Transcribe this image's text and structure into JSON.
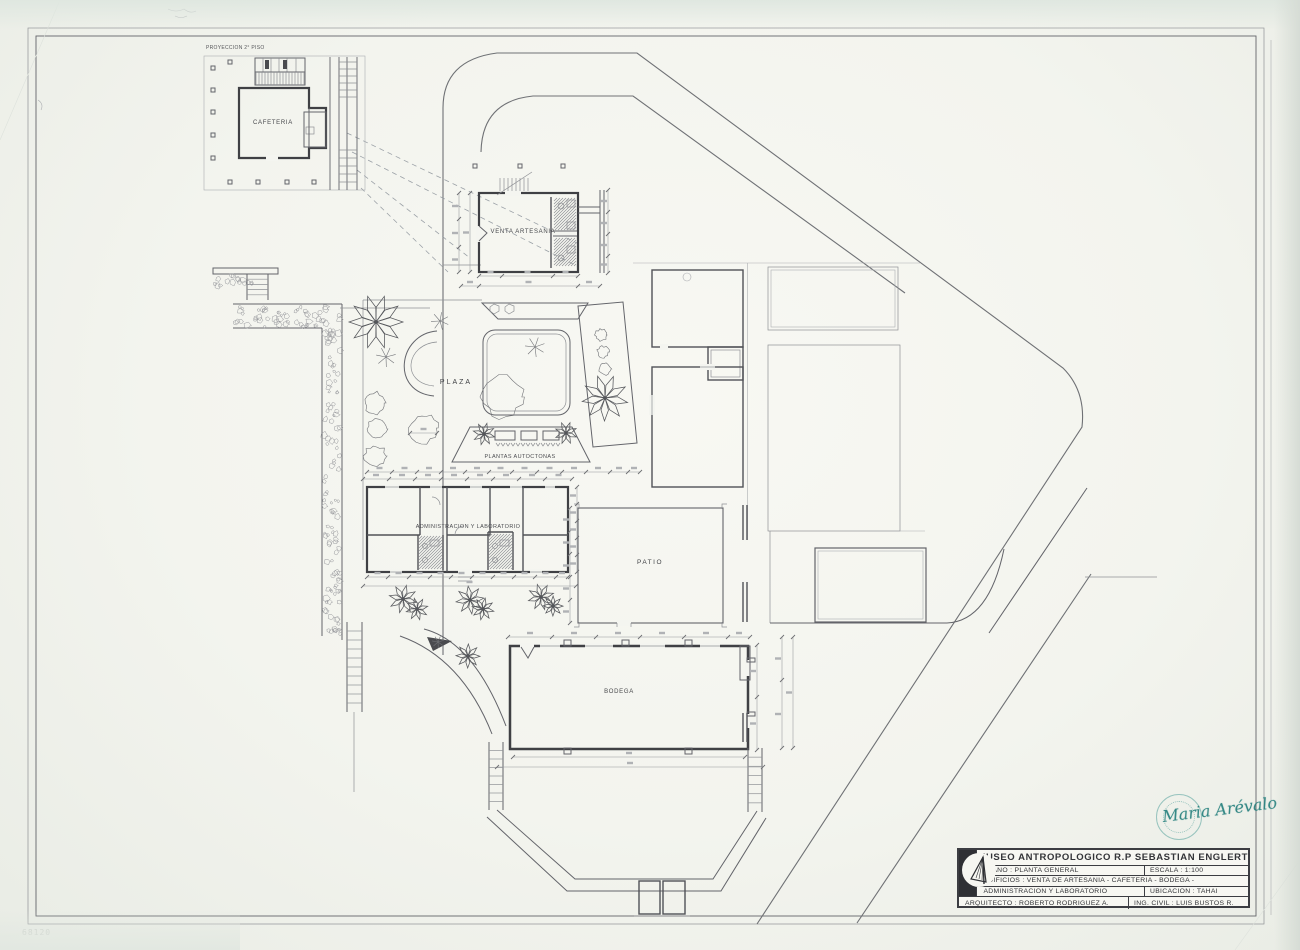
{
  "sheet": {
    "plan_labels": {
      "proyeccion": "PROYECCION 2° PISO",
      "cafeteria": "CAFETERIA",
      "venta": "VENTA ARTESANIA",
      "plaza": "PLAZA",
      "plantas": "PLANTAS AUTOCTONAS",
      "admin": "ADMINISTRACION Y LABORATORIO",
      "patio": "PATIO",
      "bodega": "BODEGA"
    },
    "pencil_note": "68120"
  },
  "title_block": {
    "museum": "MUSEO ANTROPOLOGICO R.P SEBASTIAN ENGLERT",
    "plano": "PLANO : PLANTA GENERAL",
    "escala": "ESCALA : 1:100",
    "edificios": "EDIFICIOS : VENTA DE ARTESANIA - CAFETERIA - BODEGA -",
    "admin_lab": "ADMINISTRACION Y LABORATORIO",
    "ubicacion": "UBICACION : TAHAI",
    "arquitecto": "ARQUITECTO : ROBERTO RODRIGUEZ A.",
    "ing_civil": "ING. CIVIL : LUIS BUSTOS R."
  },
  "stamp": {
    "signature": "Maria Arévalo"
  },
  "colors": {
    "ink": "#3f4044",
    "paper": "#f4f5f0",
    "stamp_teal": "#2f8d8a"
  }
}
